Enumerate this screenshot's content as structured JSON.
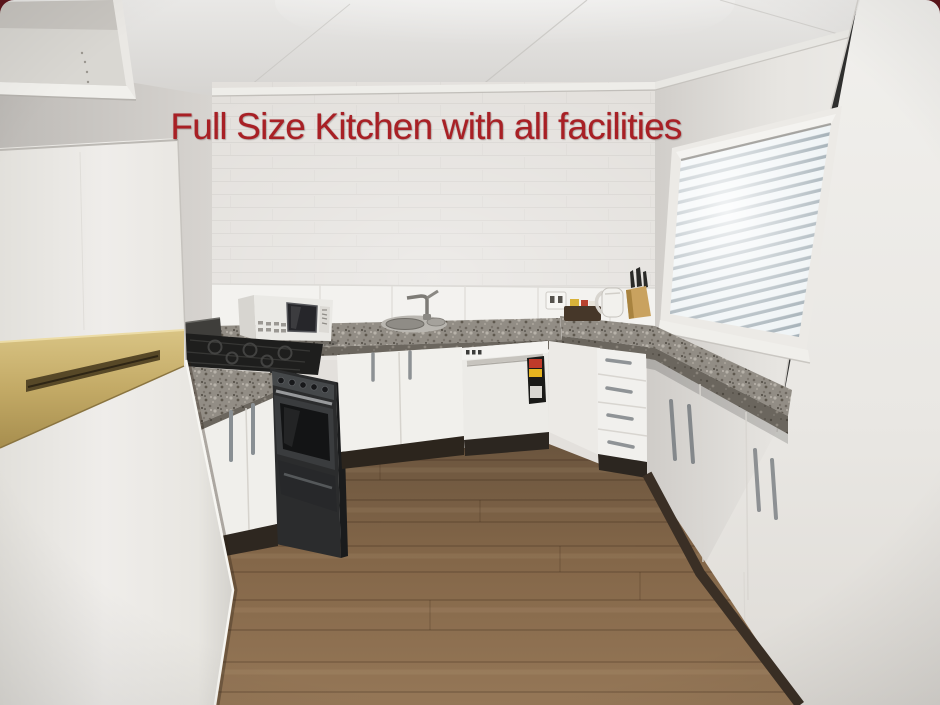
{
  "caption": {
    "text": "Full Size Kitchen with all facilities",
    "color": "#a82025"
  },
  "colors": {
    "caption_red": "#a82025",
    "wall_white": "#e3e0dc",
    "tile_white": "#f3f2ef",
    "granite_gray": "#928d85",
    "cabinet_white": "#f1f0ed",
    "floor_wood_brown": "#80644a",
    "kickboard_brown": "#32291f",
    "fridge_gold_trim": "#c3aa66",
    "appliance_black": "#232425",
    "blind_slat": "#eef3f5"
  },
  "scene_objects": [
    "refrigerator",
    "overhead-cabinet",
    "gas-stove",
    "oven",
    "microwave",
    "sink",
    "faucet",
    "dishwasher",
    "energy-rating-label",
    "drawer-bank",
    "kitchen-cabinets",
    "granite-countertop",
    "window-blinds",
    "kettle",
    "knife-block",
    "condiment-tray",
    "power-outlet",
    "wood-floor"
  ]
}
